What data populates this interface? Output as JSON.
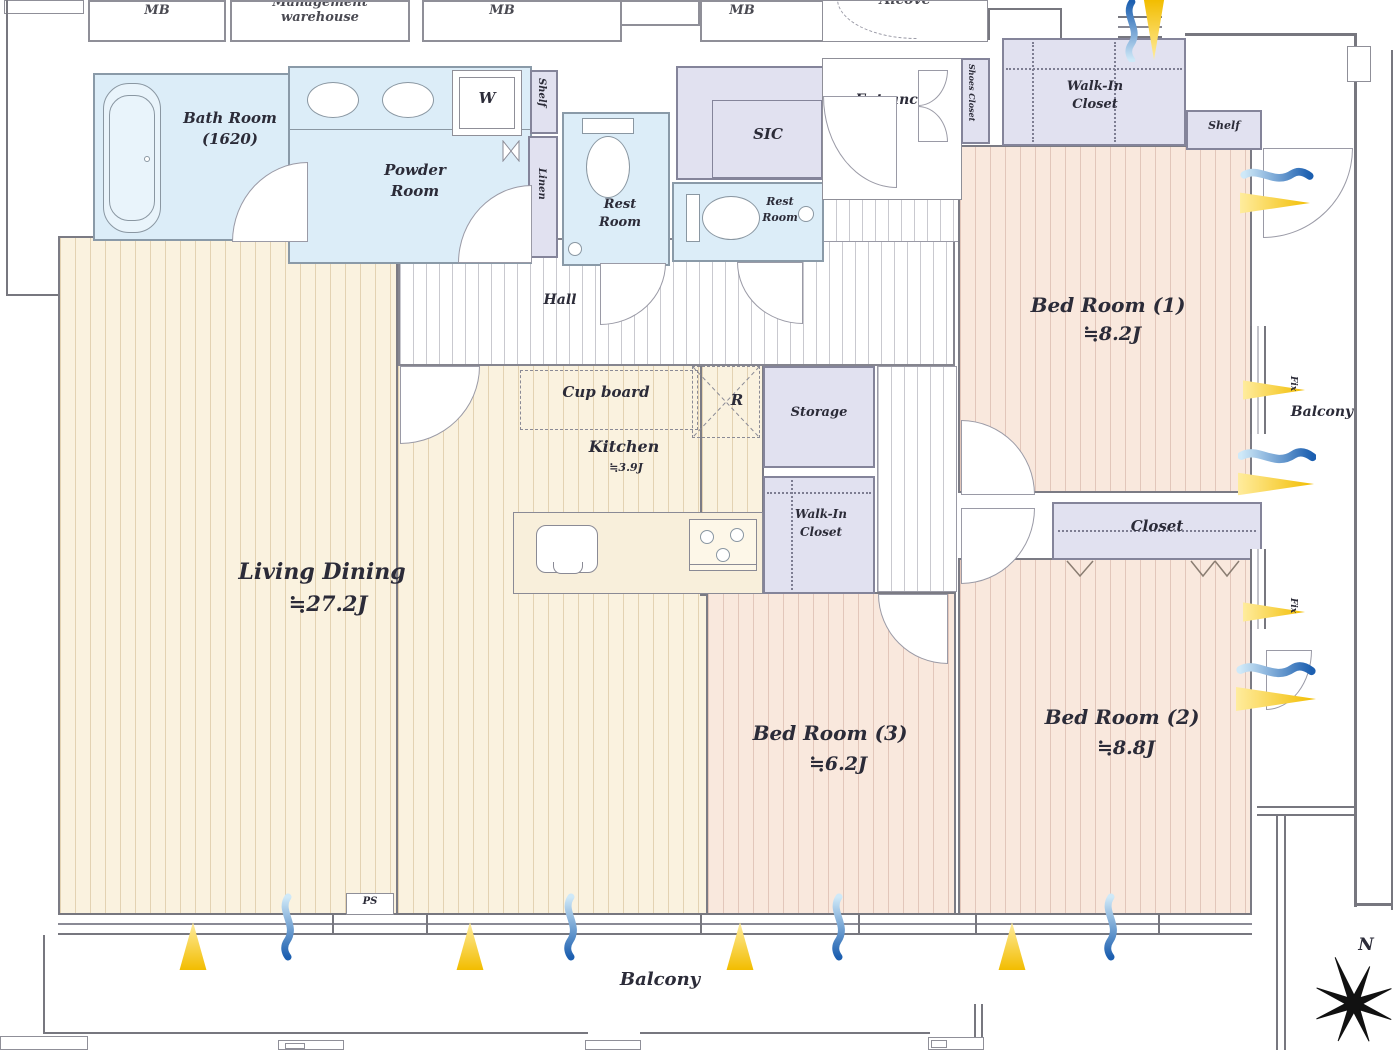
{
  "colors": {
    "sun": "#f2bd00",
    "wind_dark": "#1c5fb0",
    "wind_light": "#cfe9f8",
    "floor_wood": "#faf2df",
    "floor_bedroom": "#f9e8dd",
    "wet_room": "#dcedf8",
    "closet": "#e1e1f0"
  },
  "outside": {
    "mb1": "MB",
    "management": "Management warehouse",
    "mb2": "MB",
    "mb3": "MB",
    "alcove": "Alcove",
    "ps": "PS"
  },
  "rooms": {
    "bath": {
      "name": "Bath Room",
      "size": "(1620)"
    },
    "powder": {
      "line1": "Powder",
      "line2": "Room"
    },
    "washer": "W",
    "shelf_left": "Shelf",
    "linen": "Linen",
    "rest1": {
      "line1": "Rest",
      "line2": "Room"
    },
    "rest2": {
      "line1": "Rest",
      "line2": "Room"
    },
    "sic": "SIC",
    "entrance": "Entrance",
    "shoes_closet": "Shoes Closet",
    "wic_top": {
      "line1": "Walk-In",
      "line2": "Closet"
    },
    "shelf_top": "Shelf",
    "hall": "Hall",
    "cupboard": "Cup board",
    "fridge": "R",
    "storage": "Storage",
    "wic_mid": {
      "line1": "Walk-In",
      "line2": "Closet"
    },
    "kitchen": {
      "name": "Kitchen",
      "area": "≒3.9J"
    },
    "living": {
      "name": "Living Dining",
      "area": "≒27.2J"
    },
    "bed1": {
      "name": "Bed Room (1)",
      "area": "≒8.2J"
    },
    "bed2": {
      "name": "Bed Room (2)",
      "area": "≒8.8J"
    },
    "bed3": {
      "name": "Bed Room (3)",
      "area": "≒6.2J"
    },
    "closet": "Closet",
    "balcony_bottom": "Balcony",
    "balcony_right": "Balcony",
    "fix_a": "Fix",
    "fix_b": "Fix"
  },
  "compass": {
    "north": "N"
  }
}
